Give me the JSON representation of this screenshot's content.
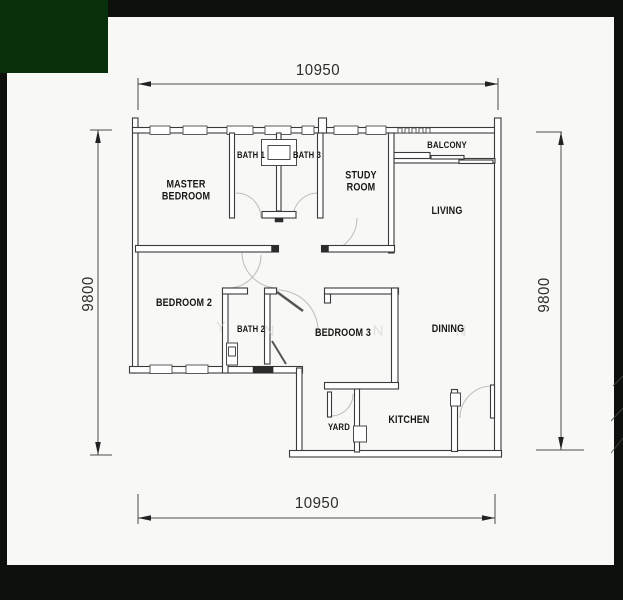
{
  "floor_plan": {
    "rooms": [
      {
        "label": "MASTER\nBEDROOM"
      },
      {
        "label": "BATH 1"
      },
      {
        "label": "BATH 3"
      },
      {
        "label": "STUDY\nROOM"
      },
      {
        "label": "BALCONY"
      },
      {
        "label": "LIVING"
      },
      {
        "label": "BEDROOM 2"
      },
      {
        "label": "BATH 2"
      },
      {
        "label": "BEDROOM 3"
      },
      {
        "label": "DINING"
      },
      {
        "label": "YARD"
      },
      {
        "label": "KITCHEN"
      }
    ],
    "dimensions": {
      "top": "10950",
      "bottom": "10950",
      "left": "9800",
      "right": "9800"
    },
    "watermark": {
      "letters": [
        "Y",
        "N",
        "N",
        "N"
      ]
    },
    "colors": {
      "accent_green": "#07300b",
      "frame_black": "#0e100e",
      "paper": "#f8f8f6",
      "wall": "#3a3a3a"
    }
  }
}
